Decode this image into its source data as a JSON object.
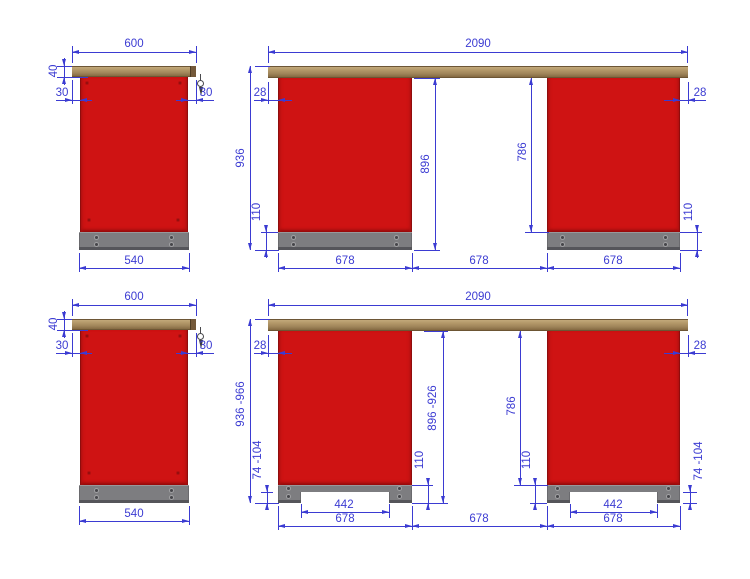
{
  "colors": {
    "dimension_blue": "#3b3bd2",
    "cabinet_red": "#cf1313",
    "plinth_gray": "#7d7d80",
    "worktop_tan": "#a0855a"
  },
  "views": {
    "side_fixed": {
      "dims": {
        "top_width": "600",
        "worktop_thickness": "40",
        "overhang_left": "30",
        "overhang_right": "30",
        "body_width": "540"
      }
    },
    "front_fixed": {
      "dims": {
        "total_width": "2090",
        "overhang_left": "28",
        "overhang_right": "28",
        "total_height": "936",
        "under_top_height": "896",
        "clear_height": "786",
        "plinth_left": "110",
        "plinth_right": "110",
        "bay_left": "678",
        "bay_middle": "678",
        "bay_right": "678"
      }
    },
    "side_adjustable": {
      "dims": {
        "top_width": "600",
        "worktop_thickness": "40",
        "overhang_left": "30",
        "overhang_right": "30",
        "body_width": "540"
      }
    },
    "front_adjustable": {
      "dims": {
        "total_width": "2090",
        "overhang_left": "28",
        "overhang_right": "28",
        "total_height": "936 -966",
        "under_top_height": "896 -926",
        "clear_height": "786",
        "feet_left": "74 -104",
        "plinth_left": "110",
        "plinth_right": "110",
        "feet_right": "74 -104",
        "notch_left": "442",
        "notch_right": "442",
        "bay_left": "678",
        "bay_middle": "678",
        "bay_right": "678"
      }
    }
  }
}
